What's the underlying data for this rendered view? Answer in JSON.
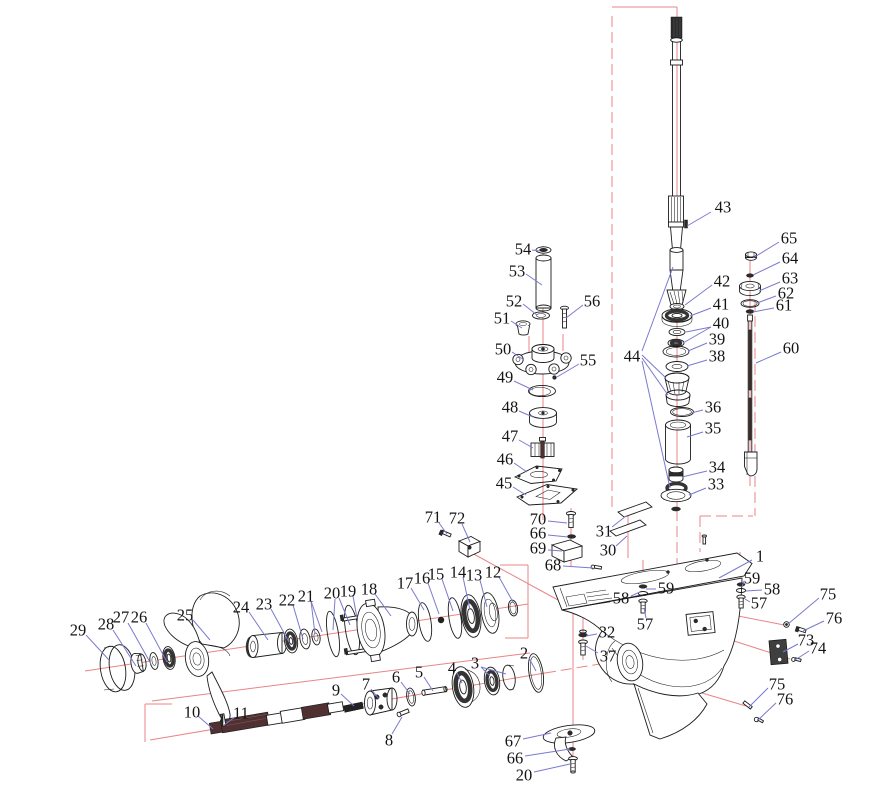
{
  "diagram": {
    "type": "exploded-parts-diagram",
    "subject": "Outboard motor lower unit gearcase exploded view",
    "colors": {
      "leader": "#7a7ace",
      "centerline": "#ea8484",
      "outline": "#1c1c1c",
      "label": "#141414",
      "background": "#ffffff"
    },
    "labels": [
      {
        "t": "43",
        "x": 723,
        "y": 207,
        "ld": [
          [
            711,
            212,
            687,
            226
          ]
        ]
      },
      {
        "t": "54",
        "x": 523,
        "y": 249,
        "ld": [
          [
            532,
            250,
            540,
            251
          ]
        ]
      },
      {
        "t": "53",
        "x": 517,
        "y": 271,
        "ld": [
          [
            526,
            274,
            542,
            285
          ]
        ]
      },
      {
        "t": "52",
        "x": 514,
        "y": 301,
        "ld": [
          [
            523,
            304,
            537,
            315
          ]
        ]
      },
      {
        "t": "51",
        "x": 502,
        "y": 318,
        "ld": [
          [
            511,
            321,
            522,
            328
          ]
        ]
      },
      {
        "t": "56",
        "x": 592,
        "y": 301,
        "ld": [
          [
            583,
            305,
            566,
            318
          ]
        ]
      },
      {
        "t": "50",
        "x": 503,
        "y": 349,
        "ld": [
          [
            512,
            352,
            524,
            360
          ]
        ]
      },
      {
        "t": "55",
        "x": 588,
        "y": 360,
        "ld": [
          [
            579,
            364,
            557,
            377
          ]
        ]
      },
      {
        "t": "49",
        "x": 505,
        "y": 377,
        "ld": [
          [
            514,
            381,
            533,
            390
          ]
        ]
      },
      {
        "t": "48",
        "x": 510,
        "y": 407,
        "ld": [
          [
            519,
            411,
            533,
            417
          ]
        ]
      },
      {
        "t": "47",
        "x": 510,
        "y": 436,
        "ld": [
          [
            519,
            440,
            533,
            448
          ]
        ]
      },
      {
        "t": "46",
        "x": 505,
        "y": 459,
        "ld": [
          [
            514,
            463,
            527,
            472
          ]
        ]
      },
      {
        "t": "45",
        "x": 504,
        "y": 483,
        "ld": [
          [
            513,
            487,
            526,
            495
          ]
        ]
      },
      {
        "t": "65",
        "x": 789,
        "y": 238,
        "ld": [
          [
            779,
            242,
            753,
            258
          ]
        ]
      },
      {
        "t": "64",
        "x": 790,
        "y": 258,
        "ld": [
          [
            780,
            262,
            753,
            275
          ]
        ]
      },
      {
        "t": "63",
        "x": 790,
        "y": 278,
        "ld": [
          [
            780,
            282,
            759,
            291
          ]
        ]
      },
      {
        "t": "62",
        "x": 786,
        "y": 293,
        "ld": [
          [
            776,
            296,
            757,
            303
          ]
        ]
      },
      {
        "t": "61",
        "x": 784,
        "y": 305,
        "ld": [
          [
            774,
            308,
            753,
            312
          ]
        ]
      },
      {
        "t": "60",
        "x": 791,
        "y": 348,
        "ld": [
          [
            781,
            352,
            756,
            363
          ]
        ]
      },
      {
        "t": "42",
        "x": 722,
        "y": 281,
        "ld": [
          [
            712,
            285,
            685,
            305
          ]
        ]
      },
      {
        "t": "41",
        "x": 721,
        "y": 304,
        "ld": [
          [
            711,
            308,
            690,
            316
          ]
        ]
      },
      {
        "t": "40",
        "x": 721,
        "y": 323,
        "ld": [
          [
            711,
            327,
            686,
            332
          ],
          [
            711,
            327,
            683,
            343
          ]
        ]
      },
      {
        "t": "39",
        "x": 717,
        "y": 339,
        "ld": [
          [
            707,
            343,
            688,
            351
          ]
        ]
      },
      {
        "t": "38",
        "x": 717,
        "y": 356,
        "ld": [
          [
            707,
            360,
            687,
            366
          ]
        ]
      },
      {
        "t": "44",
        "x": 632,
        "y": 356,
        "ld": [
          [
            642,
            351,
            673,
            267
          ],
          [
            642,
            355,
            666,
            378
          ],
          [
            642,
            358,
            668,
            395
          ],
          [
            642,
            361,
            670,
            488
          ]
        ]
      },
      {
        "t": "36",
        "x": 713,
        "y": 407,
        "ld": [
          [
            703,
            410,
            691,
            413
          ]
        ]
      },
      {
        "t": "35",
        "x": 713,
        "y": 428,
        "ld": [
          [
            703,
            432,
            687,
            437
          ]
        ]
      },
      {
        "t": "34",
        "x": 717,
        "y": 467,
        "ld": [
          [
            707,
            471,
            682,
            477
          ]
        ]
      },
      {
        "t": "33",
        "x": 716,
        "y": 484,
        "ld": [
          [
            706,
            488,
            689,
            495
          ]
        ]
      },
      {
        "t": "71",
        "x": 433,
        "y": 517,
        "ld": [
          [
            439,
            523,
            447,
            534
          ]
        ]
      },
      {
        "t": "72",
        "x": 457,
        "y": 518,
        "ld": [
          [
            462,
            524,
            470,
            542
          ]
        ]
      },
      {
        "t": "70",
        "x": 538,
        "y": 519,
        "ld": [
          [
            548,
            521,
            567,
            523
          ]
        ]
      },
      {
        "t": "66",
        "x": 538,
        "y": 533,
        "ld": [
          [
            548,
            535,
            568,
            537
          ]
        ]
      },
      {
        "t": "69",
        "x": 538,
        "y": 548,
        "ld": [
          [
            548,
            550,
            562,
            551
          ]
        ]
      },
      {
        "t": "31",
        "x": 604,
        "y": 531,
        "ld": [
          [
            612,
            527,
            626,
            516
          ]
        ]
      },
      {
        "t": "30",
        "x": 608,
        "y": 550,
        "ld": [
          [
            616,
            546,
            627,
            536
          ]
        ]
      },
      {
        "t": "68",
        "x": 553,
        "y": 565,
        "ld": [
          [
            563,
            566,
            593,
            568
          ]
        ]
      },
      {
        "t": "1",
        "x": 760,
        "y": 556,
        "ld": [
          [
            752,
            560,
            719,
            578
          ]
        ]
      },
      {
        "t": "59",
        "x": 666,
        "y": 588,
        "ld": [
          [
            656,
            589,
            646,
            589
          ]
        ]
      },
      {
        "t": "58",
        "x": 621,
        "y": 598,
        "ld": [
          [
            631,
            596,
            640,
            592
          ]
        ]
      },
      {
        "t": "57",
        "x": 645,
        "y": 624,
        "ld": [
          [
            646,
            618,
            644,
            608
          ]
        ]
      },
      {
        "t": "59",
        "x": 752,
        "y": 578,
        "ld": [
          [
            744,
            581,
            742,
            587
          ]
        ]
      },
      {
        "t": "58",
        "x": 772,
        "y": 589,
        "ld": [
          [
            762,
            590,
            746,
            591
          ]
        ]
      },
      {
        "t": "57",
        "x": 759,
        "y": 603,
        "ld": [
          [
            750,
            602,
            745,
            599
          ]
        ]
      },
      {
        "t": "32",
        "x": 607,
        "y": 632,
        "ld": [
          [
            597,
            634,
            586,
            636
          ]
        ]
      },
      {
        "t": "37",
        "x": 608,
        "y": 656,
        "ld": [
          [
            598,
            653,
            586,
            646
          ]
        ]
      },
      {
        "t": "75",
        "x": 828,
        "y": 594,
        "ld": [
          [
            819,
            598,
            788,
            624
          ]
        ]
      },
      {
        "t": "76",
        "x": 834,
        "y": 618,
        "ld": [
          [
            824,
            621,
            803,
            631
          ]
        ]
      },
      {
        "t": "73",
        "x": 806,
        "y": 640,
        "ld": [
          [
            798,
            644,
            783,
            652
          ]
        ]
      },
      {
        "t": "74",
        "x": 818,
        "y": 648,
        "ld": [
          [
            809,
            651,
            795,
            660
          ]
        ]
      },
      {
        "t": "75",
        "x": 777,
        "y": 684,
        "ld": [
          [
            768,
            688,
            749,
            707
          ]
        ]
      },
      {
        "t": "76",
        "x": 785,
        "y": 699,
        "ld": [
          [
            776,
            703,
            758,
            720
          ]
        ]
      },
      {
        "t": "67",
        "x": 513,
        "y": 741,
        "ld": [
          [
            523,
            739,
            551,
            733
          ]
        ]
      },
      {
        "t": "66",
        "x": 515,
        "y": 758,
        "ld": [
          [
            525,
            756,
            570,
            749
          ]
        ]
      },
      {
        "t": "20",
        "x": 524,
        "y": 775,
        "ld": [
          [
            534,
            772,
            570,
            764
          ]
        ]
      },
      {
        "t": "29",
        "x": 78,
        "y": 630,
        "ld": [
          [
            86,
            635,
            109,
            660
          ]
        ]
      },
      {
        "t": "28",
        "x": 106,
        "y": 624,
        "ld": [
          [
            113,
            630,
            136,
            666
          ]
        ]
      },
      {
        "t": "27",
        "x": 121,
        "y": 617,
        "ld": [
          [
            128,
            623,
            151,
            664
          ]
        ]
      },
      {
        "t": "26",
        "x": 139,
        "y": 617,
        "ld": [
          [
            146,
            623,
            167,
            662
          ]
        ]
      },
      {
        "t": "25",
        "x": 185,
        "y": 615,
        "ld": [
          [
            193,
            620,
            210,
            640
          ]
        ]
      },
      {
        "t": "24",
        "x": 241,
        "y": 607,
        "ld": [
          [
            249,
            612,
            268,
            640
          ]
        ]
      },
      {
        "t": "23",
        "x": 264,
        "y": 604,
        "ld": [
          [
            271,
            609,
            289,
            642
          ]
        ]
      },
      {
        "t": "22",
        "x": 287,
        "y": 600,
        "ld": [
          [
            293,
            605,
            303,
            639
          ]
        ]
      },
      {
        "t": "21",
        "x": 306,
        "y": 596,
        "ld": [
          [
            311,
            601,
            315,
            634
          ],
          [
            311,
            601,
            322,
            632
          ]
        ]
      },
      {
        "t": "20",
        "x": 332,
        "y": 593,
        "ld": [
          [
            335,
            599,
            333,
            630
          ],
          [
            339,
            598,
            350,
            625
          ]
        ]
      },
      {
        "t": "19",
        "x": 348,
        "y": 591,
        "ld": [
          [
            353,
            596,
            357,
            618
          ]
        ]
      },
      {
        "t": "18",
        "x": 369,
        "y": 589,
        "ld": [
          [
            375,
            594,
            391,
            616
          ]
        ]
      },
      {
        "t": "17",
        "x": 405,
        "y": 583,
        "ld": [
          [
            411,
            588,
            424,
            610
          ]
        ]
      },
      {
        "t": "16",
        "x": 422,
        "y": 578,
        "ld": [
          [
            428,
            583,
            439,
            614
          ]
        ]
      },
      {
        "t": "15",
        "x": 436,
        "y": 574,
        "ld": [
          [
            442,
            579,
            453,
            611
          ]
        ]
      },
      {
        "t": "14",
        "x": 458,
        "y": 572,
        "ld": [
          [
            463,
            577,
            470,
            610
          ]
        ]
      },
      {
        "t": "13",
        "x": 474,
        "y": 575,
        "ld": [
          [
            480,
            580,
            487,
            607
          ]
        ]
      },
      {
        "t": "12",
        "x": 493,
        "y": 572,
        "ld": [
          [
            499,
            577,
            513,
            602
          ]
        ]
      },
      {
        "t": "2",
        "x": 524,
        "y": 653,
        "ld": [
          [
            529,
            658,
            536,
            671
          ]
        ]
      },
      {
        "t": "3",
        "x": 475,
        "y": 663,
        "ld": [
          [
            481,
            667,
            490,
            676
          ],
          [
            481,
            667,
            506,
            674
          ]
        ]
      },
      {
        "t": "4",
        "x": 452,
        "y": 668,
        "ld": [
          [
            457,
            673,
            462,
            683
          ]
        ]
      },
      {
        "t": "5",
        "x": 419,
        "y": 672,
        "ld": [
          [
            424,
            677,
            433,
            691
          ]
        ]
      },
      {
        "t": "6",
        "x": 396,
        "y": 677,
        "ld": [
          [
            401,
            682,
            410,
            694
          ]
        ]
      },
      {
        "t": "7",
        "x": 366,
        "y": 684,
        "ld": [
          [
            371,
            689,
            379,
            699
          ]
        ]
      },
      {
        "t": "8",
        "x": 389,
        "y": 740,
        "ld": [
          [
            392,
            734,
            402,
            717
          ]
        ]
      },
      {
        "t": "9",
        "x": 336,
        "y": 690,
        "ld": [
          [
            341,
            694,
            354,
            706
          ]
        ]
      },
      {
        "t": "10",
        "x": 192,
        "y": 712,
        "ld": [
          [
            198,
            716,
            213,
            729
          ]
        ]
      },
      {
        "t": "11",
        "x": 241,
        "y": 713,
        "ld": [
          [
            235,
            717,
            224,
            725
          ]
        ]
      }
    ],
    "centerlines": {
      "solid": [
        [
          612,
          7,
          677,
          7
        ],
        [
          677,
          7,
          677,
          510
        ],
        [
          543,
          246,
          543,
          520
        ],
        [
          750,
          252,
          750,
          486
        ],
        [
          85,
          671,
          528,
          604
        ],
        [
          150,
          740,
          545,
          673
        ],
        [
          152,
          701,
          530,
          653
        ],
        [
          571,
          508,
          571,
          566
        ],
        [
          573,
          610,
          573,
          772
        ],
        [
          583,
          608,
          583,
          660
        ],
        [
          643,
          560,
          643,
          615
        ],
        [
          740,
          552,
          740,
          609
        ],
        [
          628,
          516,
          628,
          558
        ],
        [
          470,
          552,
          558,
          600
        ],
        [
          718,
          612,
          784,
          625
        ],
        [
          700,
          630,
          790,
          659
        ],
        [
          658,
          680,
          746,
          706
        ],
        [
          529,
          336,
          529,
          353
        ],
        [
          563,
          334,
          563,
          351
        ],
        [
          500,
          565,
          528,
          565
        ],
        [
          528,
          565,
          528,
          638
        ],
        [
          505,
          638,
          528,
          638
        ],
        [
          145,
          704,
          172,
          704
        ],
        [
          145,
          704,
          145,
          742
        ]
      ],
      "longdash": [
        [
          612,
          16,
          612,
          512
        ],
        [
          755,
          300,
          755,
          516
        ],
        [
          700,
          516,
          753,
          516
        ],
        [
          700,
          516,
          700,
          552
        ],
        [
          677,
          510,
          677,
          586
        ],
        [
          545,
          673,
          612,
          662
        ]
      ]
    }
  }
}
